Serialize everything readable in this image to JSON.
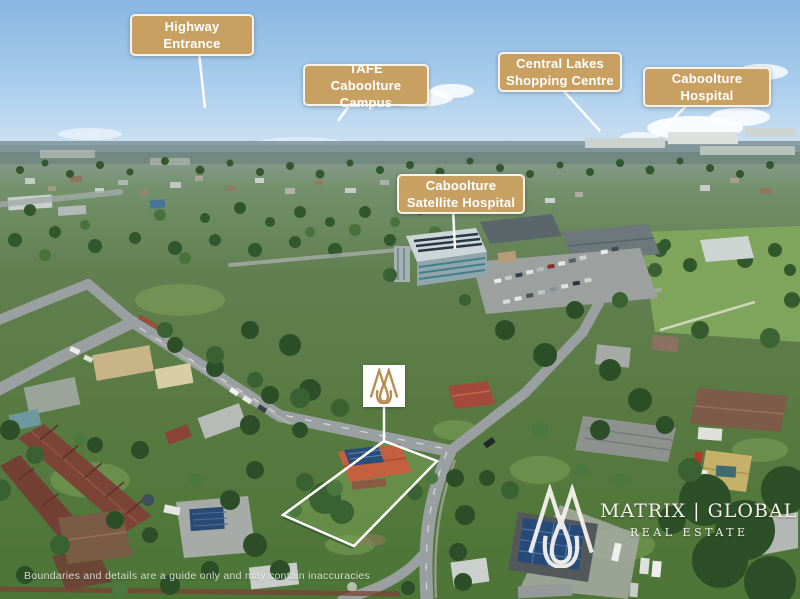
{
  "photo": {
    "disclaimer": "Boundaries and details are a guide only and may contain inaccuracies"
  },
  "callouts": {
    "highway": {
      "line1": "Highway",
      "line2": "Entrance"
    },
    "tafe": {
      "line1": "TAFE",
      "line2": "Caboolture Campus"
    },
    "central_lakes": {
      "line1": "Central Lakes",
      "line2": "Shopping Centre"
    },
    "hospital": {
      "line1": "Caboolture",
      "line2": "Hospital"
    },
    "satellite_hospital": {
      "line1": "Caboolture",
      "line2": "Satellite Hospital"
    }
  },
  "branding": {
    "name": "MATRIX | GLOBAL",
    "tagline": "REAL ESTATE"
  },
  "colors": {
    "label-bg": "#c8a062",
    "label-border": "#f7f3ea",
    "label-text": "#ffffff",
    "annotation": "#ffffff",
    "logo-gold": "#b98e55",
    "logo-text": "#f5f2ec"
  }
}
